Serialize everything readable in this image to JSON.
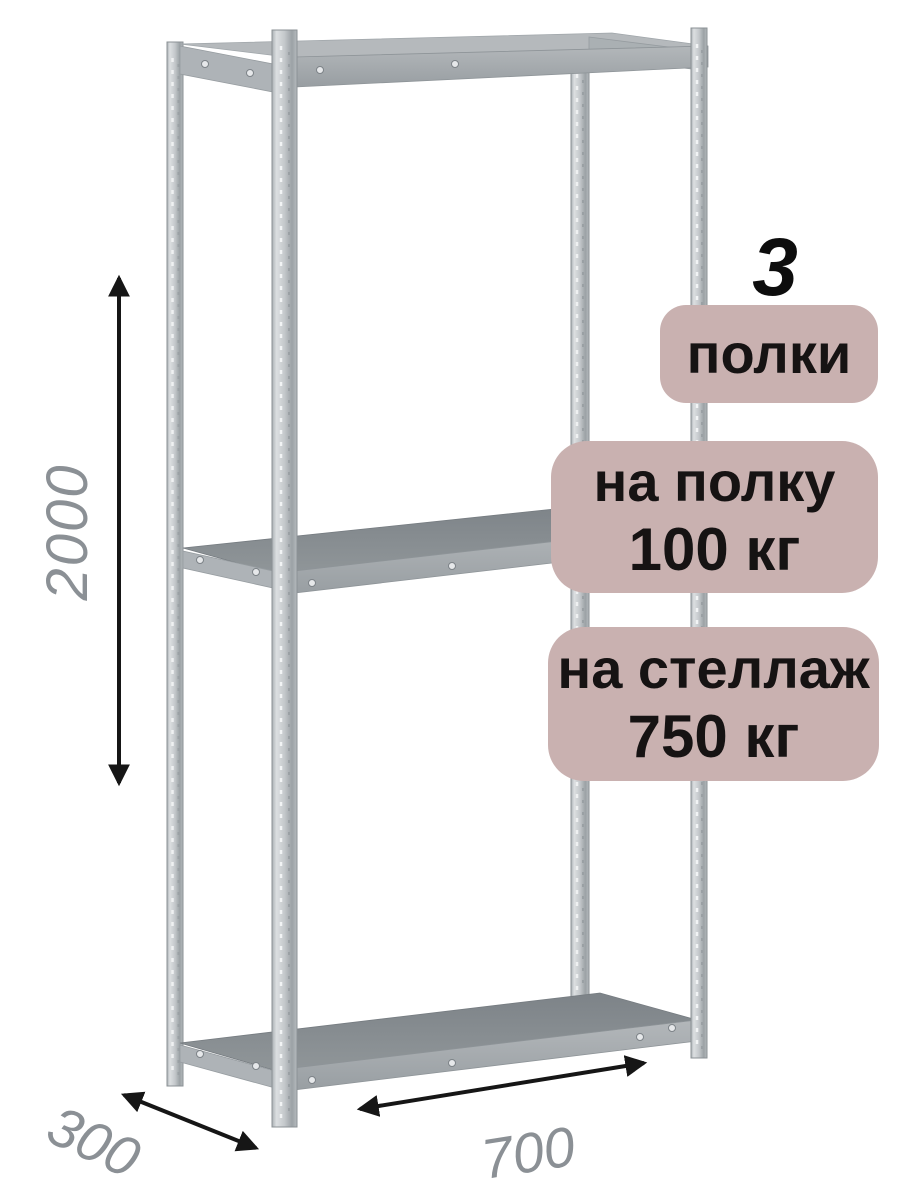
{
  "product": {
    "shelf_count": "3",
    "shelf_count_unit": "полки",
    "shelf_load_line1": "на полку",
    "shelf_load_line2": "100 кг",
    "rack_load_line1": "на стеллаж",
    "rack_load_line2": "750 кг"
  },
  "dimensions": {
    "height_mm": "2000",
    "depth_mm": "300",
    "width_mm": "700"
  },
  "colors": {
    "badge-bg": "#c9b1b0",
    "badge-text": "#161313",
    "dimension-text": "#8b9095",
    "arrow": "#161616",
    "metal-light": "#c6cacd",
    "metal-dark": "#878d92"
  }
}
